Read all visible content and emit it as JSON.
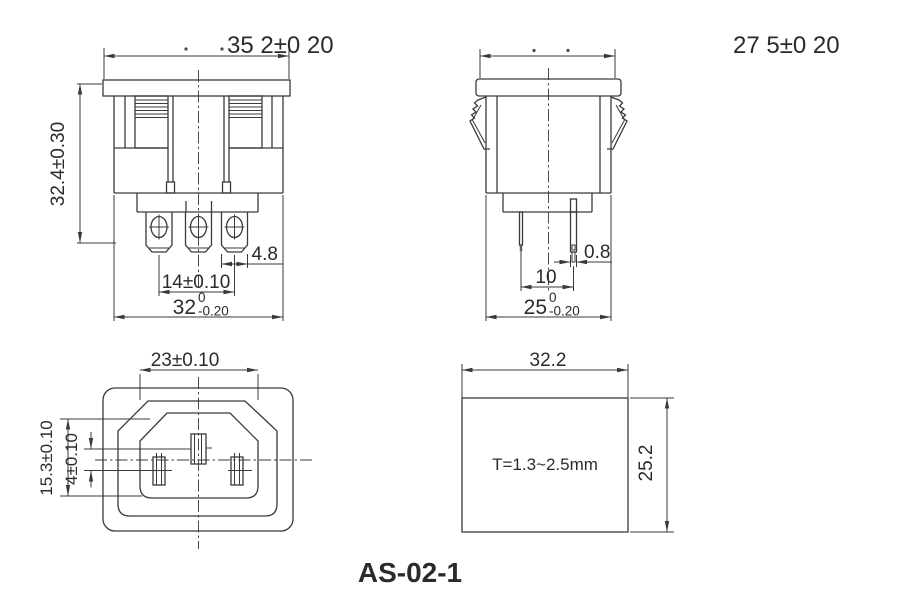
{
  "title": "AS-02-1",
  "colors": {
    "line": "#3a3a3a",
    "text": "#2b2b2b",
    "background": "#ffffff"
  },
  "views": {
    "front": {
      "overall_width": "35 2±0 20",
      "overall_height": "32.4±0.30",
      "terminal_width": "4.8",
      "terminal_spacing": "14±0.10",
      "body_width": "32",
      "body_width_tol_upper": "0",
      "body_width_tol_lower": "-0.20"
    },
    "side": {
      "overall_width": "27 5±0 20",
      "pin_thickness": "0.8",
      "pin_spacing": "10",
      "body_width": "25",
      "body_width_tol_upper": "0",
      "body_width_tol_lower": "-0.20"
    },
    "face": {
      "opening_width": "23±0.10",
      "opening_height": "15.3±0.10",
      "pin_row_offset": "4±0.10"
    },
    "cutout": {
      "width": "32.2",
      "height": "25.2",
      "panel_thickness_note": "T=1.3~2.5mm"
    }
  }
}
